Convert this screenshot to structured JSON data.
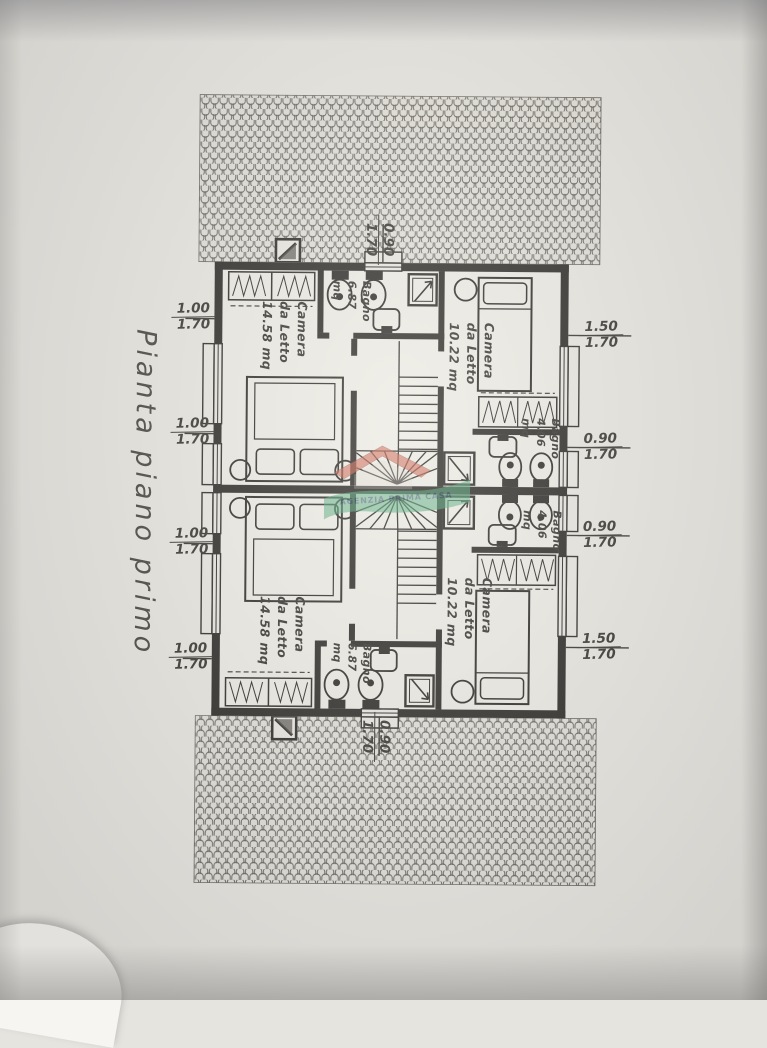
{
  "sheet": {
    "title": "Pianta piano primo",
    "watermark_text": "AGENZIA PRIMA CASA"
  },
  "rooms": {
    "bedroom_top_left": {
      "label": "Camera\nda Letto\n14.58 mq"
    },
    "bathroom_top_center": {
      "label": "Bagno\n6.87\nmq"
    },
    "bedroom_top_right": {
      "label": "Camera\nda Letto\n10.22 mq"
    },
    "bathroom_right_upper": {
      "label": "Bagno\n4.06\nmq"
    },
    "bathroom_right_lower": {
      "label": "Bagno\n4.06\nmq"
    },
    "bedroom_bottom_left": {
      "label": "Camera\nda Letto\n14.58 mq"
    },
    "bathroom_bottom_center": {
      "label": "Bagno\n6.87\nmq"
    },
    "bedroom_bottom_right": {
      "label": "Camera\nda Letto\n10.22 mq"
    }
  },
  "dimensions": {
    "left": [
      {
        "w": "1.00",
        "h": "1.70"
      },
      {
        "w": "1.00",
        "h": "1.70"
      },
      {
        "w": "1.00",
        "h": "1.70"
      },
      {
        "w": "1.00",
        "h": "1.70"
      }
    ],
    "right": [
      {
        "w": "1.50",
        "h": "1.70"
      },
      {
        "w": "0.90",
        "h": "1.70"
      },
      {
        "w": "0.90",
        "h": "1.70"
      },
      {
        "w": "1.50",
        "h": "1.70"
      }
    ],
    "top": {
      "w": "0.90",
      "h": "1.70"
    },
    "bottom": {
      "w": "0.90",
      "h": "1.70"
    }
  }
}
